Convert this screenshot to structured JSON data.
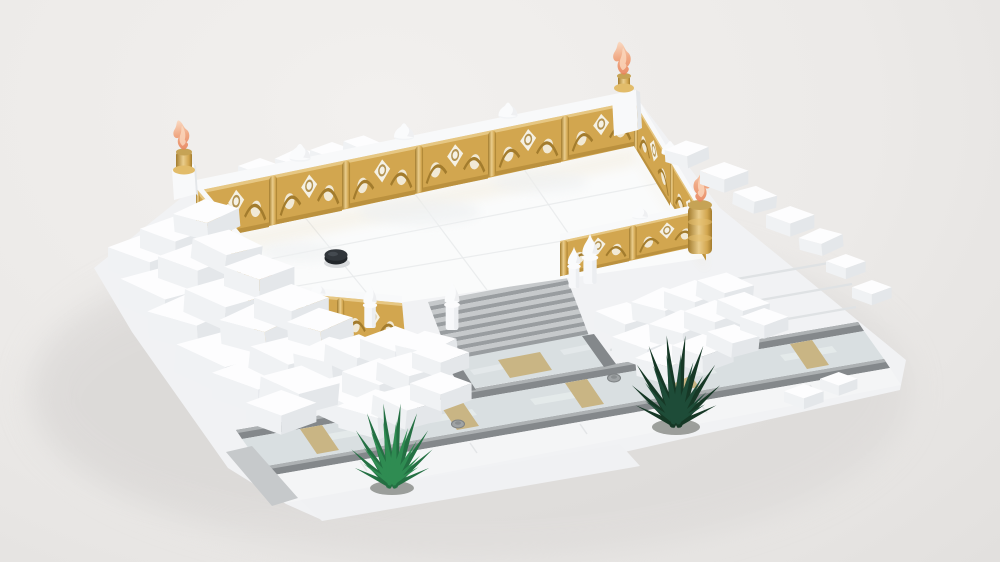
{
  "meta": {
    "title": "3D render of a LEGO snowy terrace model",
    "canvas": {
      "width": 1000,
      "height": 562
    },
    "render_style": "isometric studio render on plain light-gray backdrop, no text or UI elements visible"
  },
  "scene": {
    "description": "A LEGO-style winter terrace: a white reflective courtyard floor enclosed by ornate golden balustrades with white top rails, white onion-dome finials and corner posts topped by translucent orange flame and bird ornaments on gold caps. A gray stone staircase descends from the courtyard to a light marble road with dark gray curbs, tan paving inlays and small round utility studs. Irregular white snow-brick drifts cascade around the terrace, and two spiky evergreen plants grow from the sidewalk.",
    "objects": [
      {
        "name": "terrace-floor",
        "label": "white reflective courtyard floor with faint tile seams"
      },
      {
        "name": "black-stud",
        "label": "single black round stud on the floor"
      },
      {
        "name": "balustrade-back",
        "label": "golden openwork balustrade, back wall"
      },
      {
        "name": "balustrade-left",
        "label": "golden openwork balustrade, left wall"
      },
      {
        "name": "balustrade-right",
        "label": "golden openwork balustrade, right wall"
      },
      {
        "name": "balustrade-front-left",
        "label": "golden balustrade, front-left section"
      },
      {
        "name": "balustrade-front-right",
        "label": "golden balustrade, front-right section"
      },
      {
        "name": "corner-flame-left",
        "label": "translucent orange flame on back-left corner post"
      },
      {
        "name": "corner-bird-top",
        "label": "translucent orange bird on top corner post"
      },
      {
        "name": "corner-flame-front-left",
        "label": "orange flame on front-left gold column"
      },
      {
        "name": "corner-fish-front-right",
        "label": "orange fish ornament on front-right gold column"
      },
      {
        "name": "rail-dome-finials",
        "label": "white onion-dome finials on the rails"
      },
      {
        "name": "staircase",
        "label": "gray stone staircase, seven steps"
      },
      {
        "name": "walkway",
        "label": "walkway joining staircase to road, tan landing square"
      },
      {
        "name": "road",
        "label": "light marble road with gray curbs, tan inlays and round studs"
      },
      {
        "name": "sidewalk",
        "label": "white sidewalk rows in front of the road"
      },
      {
        "name": "snow-drifts",
        "label": "jumbled white snow bricks around the terrace"
      },
      {
        "name": "plant-left",
        "label": "green spiky plant on sidewalk"
      },
      {
        "name": "plant-right",
        "label": "dark green spiky plant near road"
      }
    ]
  },
  "colors": {
    "background_top": "#F2F0EE",
    "background_mid": "#ECEAE8",
    "background_bottom": "#E2E0DE",
    "ground_shadow": "#D5D3D1",
    "snow_base": "#F1F2F4",
    "snow_top": "#FDFDFE",
    "snow_front": "#E4E7EA",
    "snow_side": "#F0F2F4",
    "floor_white": "#FAFBFB",
    "floor_line": "#E8EAEB",
    "gold": "#D2A64F",
    "gold_light": "#EACD8C",
    "gold_dark": "#A37C2D",
    "rail_white": "#F8F9FA",
    "flame_orange": "#F0A077",
    "flame_deep": "#E8835A",
    "flame_light": "#FBD8BE",
    "step_tread": "#C6C9CB",
    "step_riser": "#999DA0",
    "road_surface": "#D9DFE1",
    "road_marble": "#EDF2F3",
    "curb_face": "#84888B",
    "curb_top": "#ADB1B3",
    "tan_inlay": "#C9B584",
    "plant_light": "#2F8C52",
    "plant_light_back": "#247043",
    "plant_dark": "#1E4C38",
    "plant_dark_back": "#163826",
    "plant_pot": "#565A52",
    "black_stud": "#22262A",
    "black_stud_top": "#31363B"
  }
}
